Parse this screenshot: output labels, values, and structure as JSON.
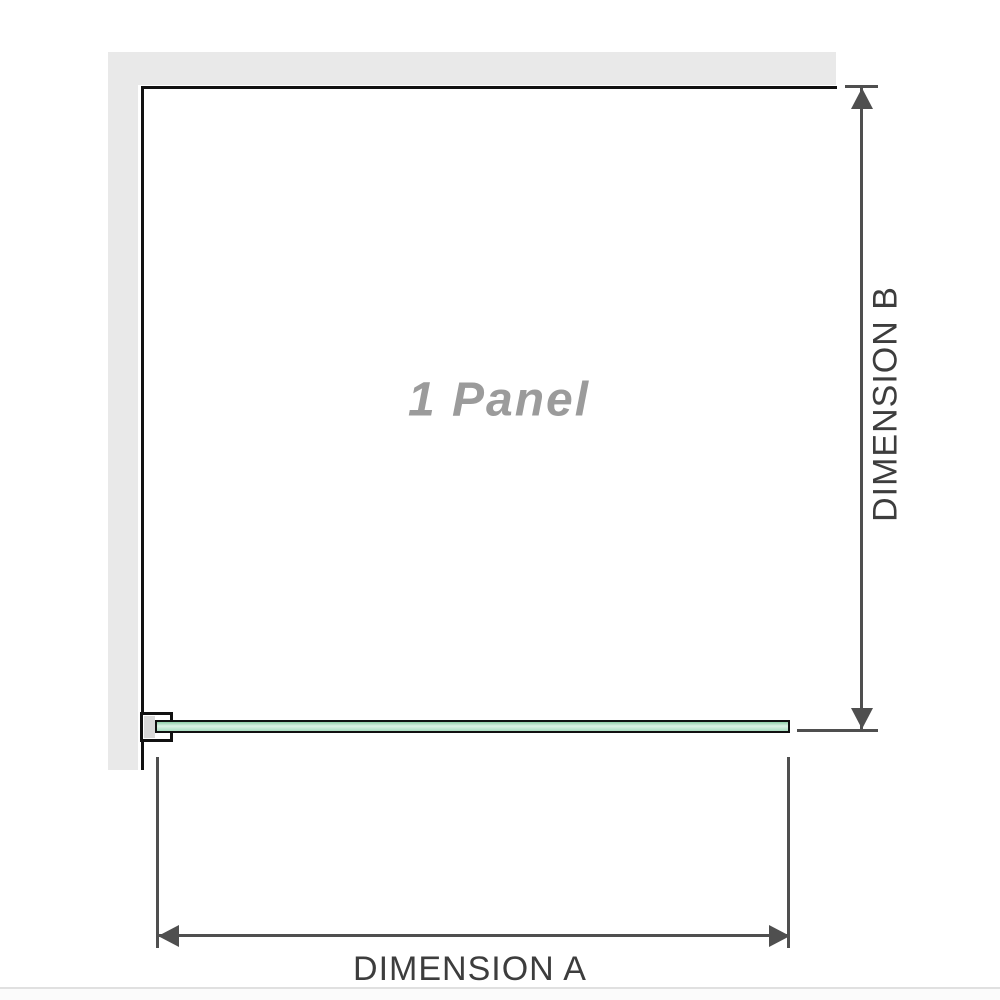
{
  "diagram": {
    "title": "shower-panel-top-view",
    "panel_label": "1 Panel",
    "dimension_a_label": "DIMENSION A",
    "dimension_b_label": "DIMENSION B",
    "colors": {
      "wall": "#e9e9e9",
      "wall_edge": "#111111",
      "dimension": "#4f4f4f",
      "label_text": "#3d3d3d",
      "panel_text": "#9b9b9b",
      "glass_border": "#111111",
      "glass_top": "#8fcfa9",
      "glass_mid": "#ddf2e5",
      "glass_bottom": "#a8dec0",
      "bracket_pad": "#d9d9d9",
      "bottom_rule": "#e0e0e0"
    }
  }
}
